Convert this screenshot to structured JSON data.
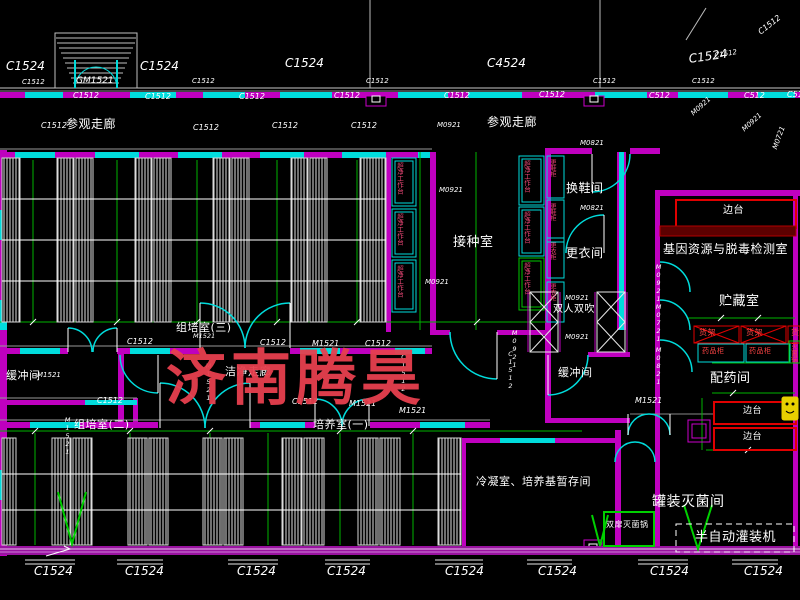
{
  "watermark": {
    "text": "济南腾昊",
    "color": "#e7404f"
  },
  "colors": {
    "wall_magenta": "#bf00bf",
    "window_cyan": "#00dcdc",
    "dimension_green": "#00b400",
    "equipment_red": "#e00000",
    "accent_yellow": "#e8d000",
    "text_white": "#ffffff",
    "small_red_text": "#ff4545",
    "vertical_pink_text": "#f04878"
  },
  "rooms": [
    {
      "label": "参观走廊",
      "x": 66,
      "y": 118,
      "size": 12
    },
    {
      "label": "参观走廊",
      "x": 487,
      "y": 116,
      "size": 12
    },
    {
      "label": "组培室(三)",
      "x": 176,
      "y": 322,
      "size": 11
    },
    {
      "label": "接种室",
      "x": 453,
      "y": 236,
      "size": 13
    },
    {
      "label": "换鞋间",
      "x": 566,
      "y": 182,
      "size": 12
    },
    {
      "label": "更衣间",
      "x": 566,
      "y": 247,
      "size": 12
    },
    {
      "label": "缓冲间",
      "x": 6,
      "y": 370,
      "size": 11
    },
    {
      "label": "缓冲间",
      "x": 558,
      "y": 367,
      "size": 11
    },
    {
      "label": "洁净走廊",
      "x": 225,
      "y": 366,
      "size": 11
    },
    {
      "label": "组培室(二)",
      "x": 74,
      "y": 419,
      "size": 11
    },
    {
      "label": "培养室(一)",
      "x": 313,
      "y": 419,
      "size": 11
    },
    {
      "label": "冷凝室、培养基暂存间",
      "x": 476,
      "y": 476,
      "size": 11
    },
    {
      "label": "基因资源与脱毒检测室",
      "x": 663,
      "y": 243,
      "size": 12
    },
    {
      "label": "贮藏室",
      "x": 719,
      "y": 295,
      "size": 13
    },
    {
      "label": "配药间",
      "x": 710,
      "y": 372,
      "size": 13
    },
    {
      "label": "罐装灭菌间",
      "x": 652,
      "y": 495,
      "size": 14
    }
  ],
  "codes": [
    {
      "label": "C1524",
      "x": 6,
      "y": 60,
      "size": 12
    },
    {
      "label": "C1524",
      "x": 140,
      "y": 60,
      "size": 12
    },
    {
      "label": "C1524",
      "x": 285,
      "y": 57,
      "size": 12
    },
    {
      "label": "C4524",
      "x": 487,
      "y": 57,
      "size": 12
    },
    {
      "label": "C1524",
      "x": 688,
      "y": 53,
      "size": 12,
      "rot": -8
    },
    {
      "label": "C1512",
      "x": 714,
      "y": 53,
      "size": 7,
      "rot": -10
    },
    {
      "label": "C1512",
      "x": 757,
      "y": 30,
      "size": 8,
      "rot": -38
    },
    {
      "label": "GM1521",
      "x": 76,
      "y": 77,
      "size": 9
    },
    {
      "label": "C1512",
      "x": 22,
      "y": 79,
      "size": 7
    },
    {
      "label": "C1512",
      "x": 192,
      "y": 78,
      "size": 7
    },
    {
      "label": "C1512",
      "x": 366,
      "y": 78,
      "size": 7
    },
    {
      "label": "C1512",
      "x": 593,
      "y": 78,
      "size": 7
    },
    {
      "label": "C1512",
      "x": 692,
      "y": 78,
      "size": 7
    },
    {
      "label": "C1512",
      "x": 73,
      "y": 92,
      "size": 8
    },
    {
      "label": "C1512",
      "x": 145,
      "y": 93,
      "size": 8
    },
    {
      "label": "C1512",
      "x": 239,
      "y": 93,
      "size": 8
    },
    {
      "label": "C1512",
      "x": 334,
      "y": 92,
      "size": 8
    },
    {
      "label": "C1512",
      "x": 444,
      "y": 92,
      "size": 8
    },
    {
      "label": "C1512",
      "x": 539,
      "y": 91,
      "size": 8
    },
    {
      "label": "C512",
      "x": 649,
      "y": 92,
      "size": 8
    },
    {
      "label": "C512",
      "x": 744,
      "y": 92,
      "size": 8
    },
    {
      "label": "C512",
      "x": 787,
      "y": 91,
      "size": 8
    },
    {
      "label": "C1512",
      "x": 41,
      "y": 122,
      "size": 8
    },
    {
      "label": "C1512",
      "x": 193,
      "y": 124,
      "size": 8
    },
    {
      "label": "C1512",
      "x": 272,
      "y": 122,
      "size": 8
    },
    {
      "label": "C1512",
      "x": 351,
      "y": 122,
      "size": 8
    },
    {
      "label": "M0921",
      "x": 437,
      "y": 122,
      "size": 7
    },
    {
      "label": "M0921",
      "x": 690,
      "y": 112,
      "size": 7,
      "rot": -42
    },
    {
      "label": "M0921",
      "x": 741,
      "y": 128,
      "size": 7,
      "rot": -42
    },
    {
      "label": "M0721",
      "x": 772,
      "y": 148,
      "size": 7,
      "rot": -70
    },
    {
      "label": "M0821",
      "x": 580,
      "y": 140,
      "size": 7
    },
    {
      "label": "M0821",
      "x": 580,
      "y": 205,
      "size": 7
    },
    {
      "label": "M0921",
      "x": 439,
      "y": 187,
      "size": 7
    },
    {
      "label": "M0921",
      "x": 425,
      "y": 279,
      "size": 7
    },
    {
      "label": "M0921",
      "x": 565,
      "y": 295,
      "size": 7
    },
    {
      "label": "M0921",
      "x": 565,
      "y": 334,
      "size": 7
    },
    {
      "label": "M0921",
      "x": 511,
      "y": 329,
      "size": 6.5,
      "vertical": true
    },
    {
      "label": "C1512",
      "x": 507,
      "y": 350,
      "size": 6.5,
      "vertical": true
    },
    {
      "label": "M1521",
      "x": 193,
      "y": 333,
      "size": 6.5
    },
    {
      "label": "C1512",
      "x": 127,
      "y": 338,
      "size": 8
    },
    {
      "label": "C1512",
      "x": 260,
      "y": 339,
      "size": 8
    },
    {
      "label": "M1521",
      "x": 312,
      "y": 340,
      "size": 8
    },
    {
      "label": "C1512",
      "x": 365,
      "y": 340,
      "size": 8
    },
    {
      "label": "C1512",
      "x": 400,
      "y": 353,
      "size": 6.5,
      "vertical": true
    },
    {
      "label": "M1521",
      "x": 205,
      "y": 362,
      "size": 6.5,
      "vertical": true
    },
    {
      "label": "M1521",
      "x": 37,
      "y": 372,
      "size": 7
    },
    {
      "label": "M1521",
      "x": 64,
      "y": 416,
      "size": 6.5,
      "vertical": true
    },
    {
      "label": "C1512",
      "x": 97,
      "y": 397,
      "size": 8
    },
    {
      "label": "C1512",
      "x": 292,
      "y": 398,
      "size": 8
    },
    {
      "label": "M1521",
      "x": 349,
      "y": 400,
      "size": 8
    },
    {
      "label": "M1521",
      "x": 399,
      "y": 407,
      "size": 8
    },
    {
      "label": "M1521",
      "x": 635,
      "y": 397,
      "size": 8
    },
    {
      "label": "M0921",
      "x": 655,
      "y": 263,
      "size": 6.5,
      "vertical": true
    },
    {
      "label": "M0721",
      "x": 655,
      "y": 303,
      "size": 6.5,
      "vertical": true
    },
    {
      "label": "M0821",
      "x": 655,
      "y": 346,
      "size": 6.5,
      "vertical": true
    },
    {
      "label": "C1524",
      "x": 34,
      "y": 565,
      "size": 12
    },
    {
      "label": "C1524",
      "x": 125,
      "y": 565,
      "size": 12
    },
    {
      "label": "C1524",
      "x": 237,
      "y": 565,
      "size": 12
    },
    {
      "label": "C1524",
      "x": 327,
      "y": 565,
      "size": 12
    },
    {
      "label": "C1524",
      "x": 445,
      "y": 565,
      "size": 12
    },
    {
      "label": "C1524",
      "x": 538,
      "y": 565,
      "size": 12
    },
    {
      "label": "C1524",
      "x": 650,
      "y": 565,
      "size": 12
    },
    {
      "label": "C1524",
      "x": 744,
      "y": 565,
      "size": 12
    }
  ],
  "equipment": [
    {
      "label": "双人双吹",
      "x": 553,
      "y": 305,
      "size": 10
    },
    {
      "label": "边台",
      "x": 723,
      "y": 206,
      "size": 10
    },
    {
      "label": "边台",
      "x": 743,
      "y": 407,
      "size": 9
    },
    {
      "label": "边台",
      "x": 743,
      "y": 433,
      "size": 9
    },
    {
      "label": "货架",
      "x": 699,
      "y": 329,
      "size": 8,
      "color": "#ff4545"
    },
    {
      "label": "货架",
      "x": 746,
      "y": 329,
      "size": 8,
      "color": "#ff4545"
    },
    {
      "label": "货架",
      "x": 791,
      "y": 329,
      "size": 8,
      "color": "#ff4545"
    },
    {
      "label": "药品柜",
      "x": 702,
      "y": 348,
      "size": 7,
      "color": "#ff4545"
    },
    {
      "label": "药品柜",
      "x": 749,
      "y": 348,
      "size": 7,
      "color": "#ff4545"
    },
    {
      "label": "灭菌锅",
      "x": 790,
      "y": 343,
      "size": 6.5,
      "color": "#ff4545",
      "vertical": true
    },
    {
      "label": "双扉灭菌锅",
      "x": 606,
      "y": 521,
      "size": 8
    },
    {
      "label": "半自动灌装机",
      "x": 695,
      "y": 531,
      "size": 13
    },
    {
      "label": "超净工作台",
      "x": 396,
      "y": 162,
      "size": 6.5,
      "color": "#f04878",
      "vertical": true
    },
    {
      "label": "超净工作台",
      "x": 396,
      "y": 213,
      "size": 6.5,
      "color": "#f04878",
      "vertical": true
    },
    {
      "label": "超净工作台",
      "x": 396,
      "y": 265,
      "size": 6.5,
      "color": "#f04878",
      "vertical": true
    },
    {
      "label": "超净工作台",
      "x": 523,
      "y": 160,
      "size": 6.5,
      "color": "#f04878",
      "vertical": true
    },
    {
      "label": "超净工作台",
      "x": 523,
      "y": 211,
      "size": 6.5,
      "color": "#f04878",
      "vertical": true
    },
    {
      "label": "超净工作台",
      "x": 523,
      "y": 262,
      "size": 6.5,
      "color": "#f04878",
      "vertical": true
    },
    {
      "label": "更鞋柜",
      "x": 549,
      "y": 159,
      "size": 6,
      "color": "#f04878",
      "vertical": true
    },
    {
      "label": "更鞋柜",
      "x": 549,
      "y": 203,
      "size": 6,
      "color": "#f04878",
      "vertical": true
    },
    {
      "label": "更衣柜",
      "x": 549,
      "y": 242,
      "size": 6,
      "color": "#f04878",
      "vertical": true
    },
    {
      "label": "更衣柜",
      "x": 549,
      "y": 283,
      "size": 6,
      "color": "#f04878",
      "vertical": true
    }
  ]
}
